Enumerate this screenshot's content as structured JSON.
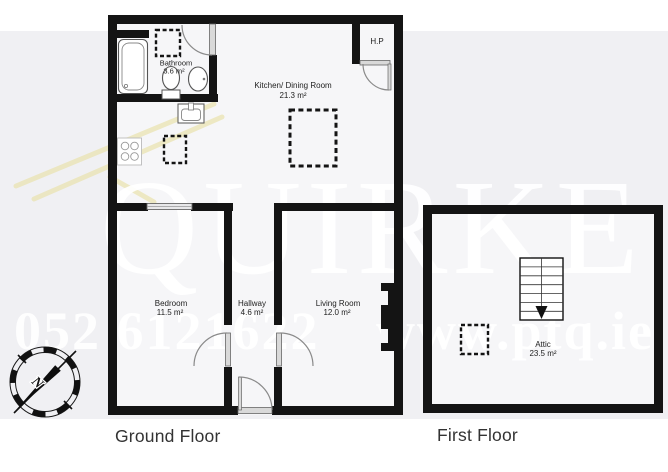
{
  "floors": {
    "ground": {
      "title": "Ground Floor",
      "rooms": {
        "bathroom": {
          "name": "Bathroom",
          "area": "3.6 m²"
        },
        "kitchen": {
          "name": "Kitchen/ Dining Room",
          "area": "21.3 m²"
        },
        "hot_press": {
          "name": "H.P"
        },
        "bedroom": {
          "name": "Bedroom",
          "area": "11.5 m²"
        },
        "hallway": {
          "name": "Hallway",
          "area": "4.6 m²"
        },
        "living": {
          "name": "Living Room",
          "area": "12.0 m²"
        }
      }
    },
    "first": {
      "title": "First Floor",
      "rooms": {
        "attic": {
          "name": "Attic",
          "area": "23.5 m²"
        }
      }
    }
  },
  "watermark": {
    "brand": "QUIRKE",
    "phone": "052 6121622",
    "website": "www.ptq.ie"
  },
  "compass": {
    "north_label": "N"
  },
  "colors": {
    "wall": "#141414",
    "background_band": "#f0f0f3",
    "floor_fill": "#f6f6f8",
    "roof_watermark": "#e9e2a8",
    "fixture_stroke": "#666666",
    "arc_stroke": "#8a8a8a"
  }
}
